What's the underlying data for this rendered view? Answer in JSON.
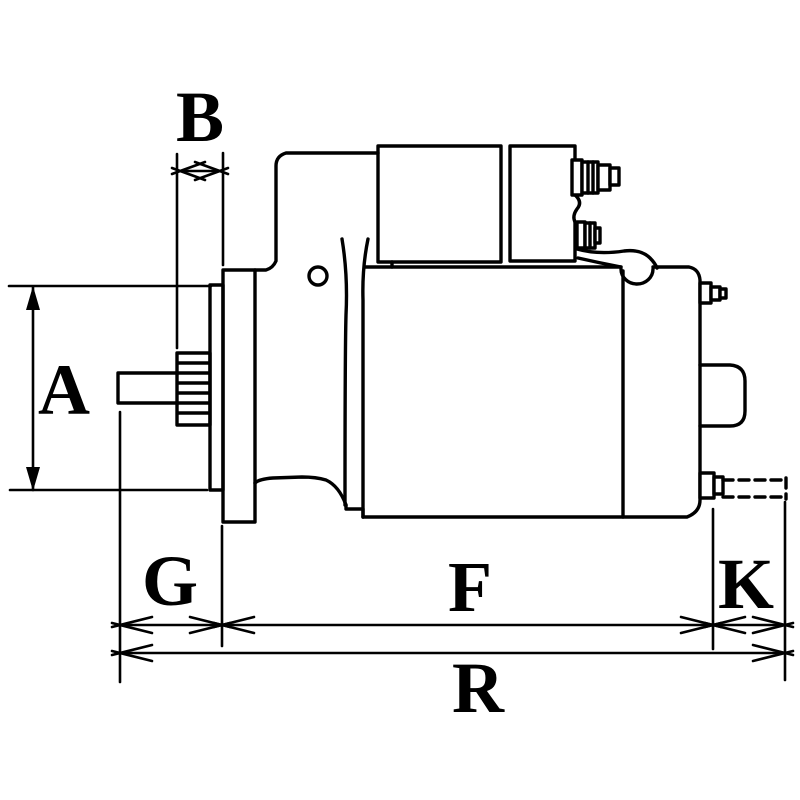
{
  "diagram": {
    "type": "technical-dimensional-drawing",
    "subject": "starter-motor-side-view",
    "background_color": "#ffffff",
    "line_color": "#000000",
    "labels": {
      "a": "A",
      "b": "B",
      "g": "G",
      "f": "F",
      "k": "K",
      "r": "R"
    }
  }
}
